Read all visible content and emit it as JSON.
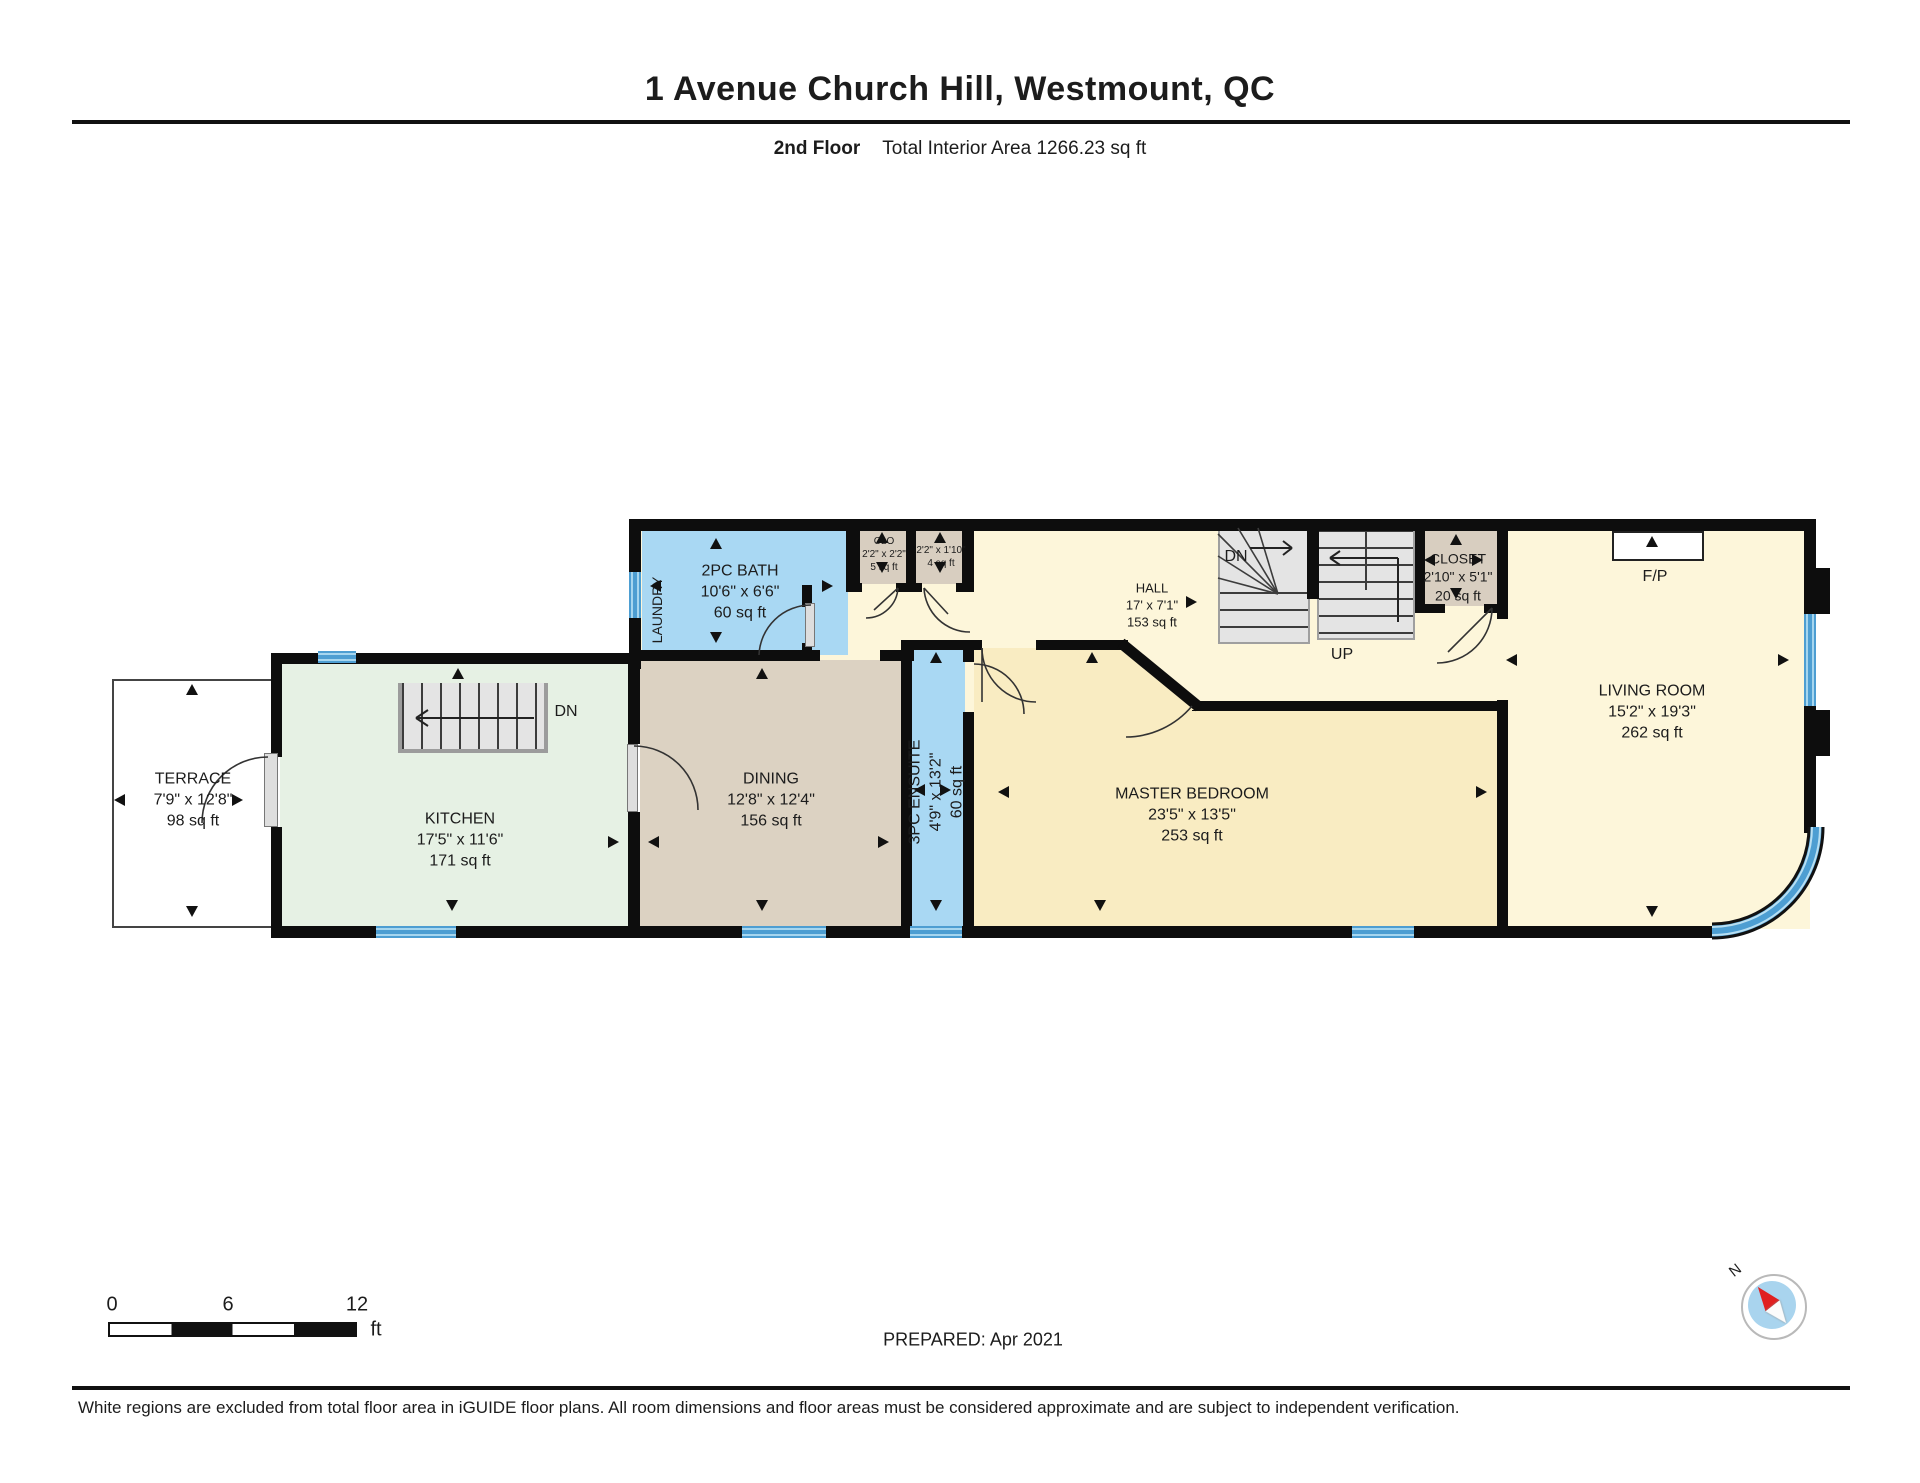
{
  "header": {
    "title": "1 Avenue Church Hill, Westmount, QC",
    "floor_label": "2nd Floor",
    "area_label": "Total Interior Area 1266.23 sq ft"
  },
  "rooms": {
    "terrace": {
      "name": "TERRACE",
      "dims": "7'9\" x 12'8\"",
      "area": "98 sq ft"
    },
    "kitchen": {
      "name": "KITCHEN",
      "dims": "17'5\" x 11'6\"",
      "area": "171 sq ft"
    },
    "bath": {
      "name": "2PC BATH",
      "dims": "10'6\" x 6'6\"",
      "area": "60 sq ft"
    },
    "laundry": {
      "name": "LAUNDRY"
    },
    "closet_small_1": {
      "name": "CLO",
      "dims": "2'2\" x 2'2\"",
      "area": "5 sq ft"
    },
    "closet_small_2": {
      "dims": "2'2\" x 1'10\"",
      "area": "4 sq ft"
    },
    "hall": {
      "name": "HALL",
      "dims": "17' x 7'1\"",
      "area": "153 sq ft"
    },
    "closet": {
      "name": "CLOSET",
      "dims": "2'10\" x 5'1\"",
      "area": "20 sq ft"
    },
    "living": {
      "name": "LIVING ROOM",
      "dims": "15'2\" x 19'3\"",
      "area": "262 sq ft"
    },
    "dining": {
      "name": "DINING",
      "dims": "12'8\" x 12'4\"",
      "area": "156 sq ft"
    },
    "ensuite": {
      "name": "3PC ENSUITE",
      "dims": "4'9\" x 13'2\"",
      "area": "60 sq ft"
    },
    "master": {
      "name": "MASTER BEDROOM",
      "dims": "23'5\" x 13'5\"",
      "area": "253 sq ft"
    }
  },
  "annotations": {
    "stairs_down_kitchen": "DN",
    "stairs_down_hall": "DN",
    "stairs_up_hall": "UP",
    "fireplace": "F/P",
    "compass_north": "N"
  },
  "scale_bar": {
    "tick_0": "0",
    "tick_6": "6",
    "tick_12": "12",
    "unit": "ft"
  },
  "footer": {
    "prepared": "PREPARED: Apr 2021",
    "disclaimer": "White regions are excluded from total floor area in iGUIDE floor plans. All room dimensions and floor areas must be considered approximate and are subject to independent verification."
  },
  "colors": {
    "wall": "#0d0d0d",
    "window": "#4d9ed2",
    "kitchen_fill": "#e6f1e4",
    "bath_fill": "#a9d8f3",
    "dining_fill": "#dcd2c2",
    "hall_fill": "#fdf6da",
    "master_fill": "#f9ecc2",
    "closet_fill": "#d8cec0",
    "stairs_fill": "#e4e4e4",
    "compass_red": "#e02020",
    "compass_blue": "#a9d4ee"
  }
}
